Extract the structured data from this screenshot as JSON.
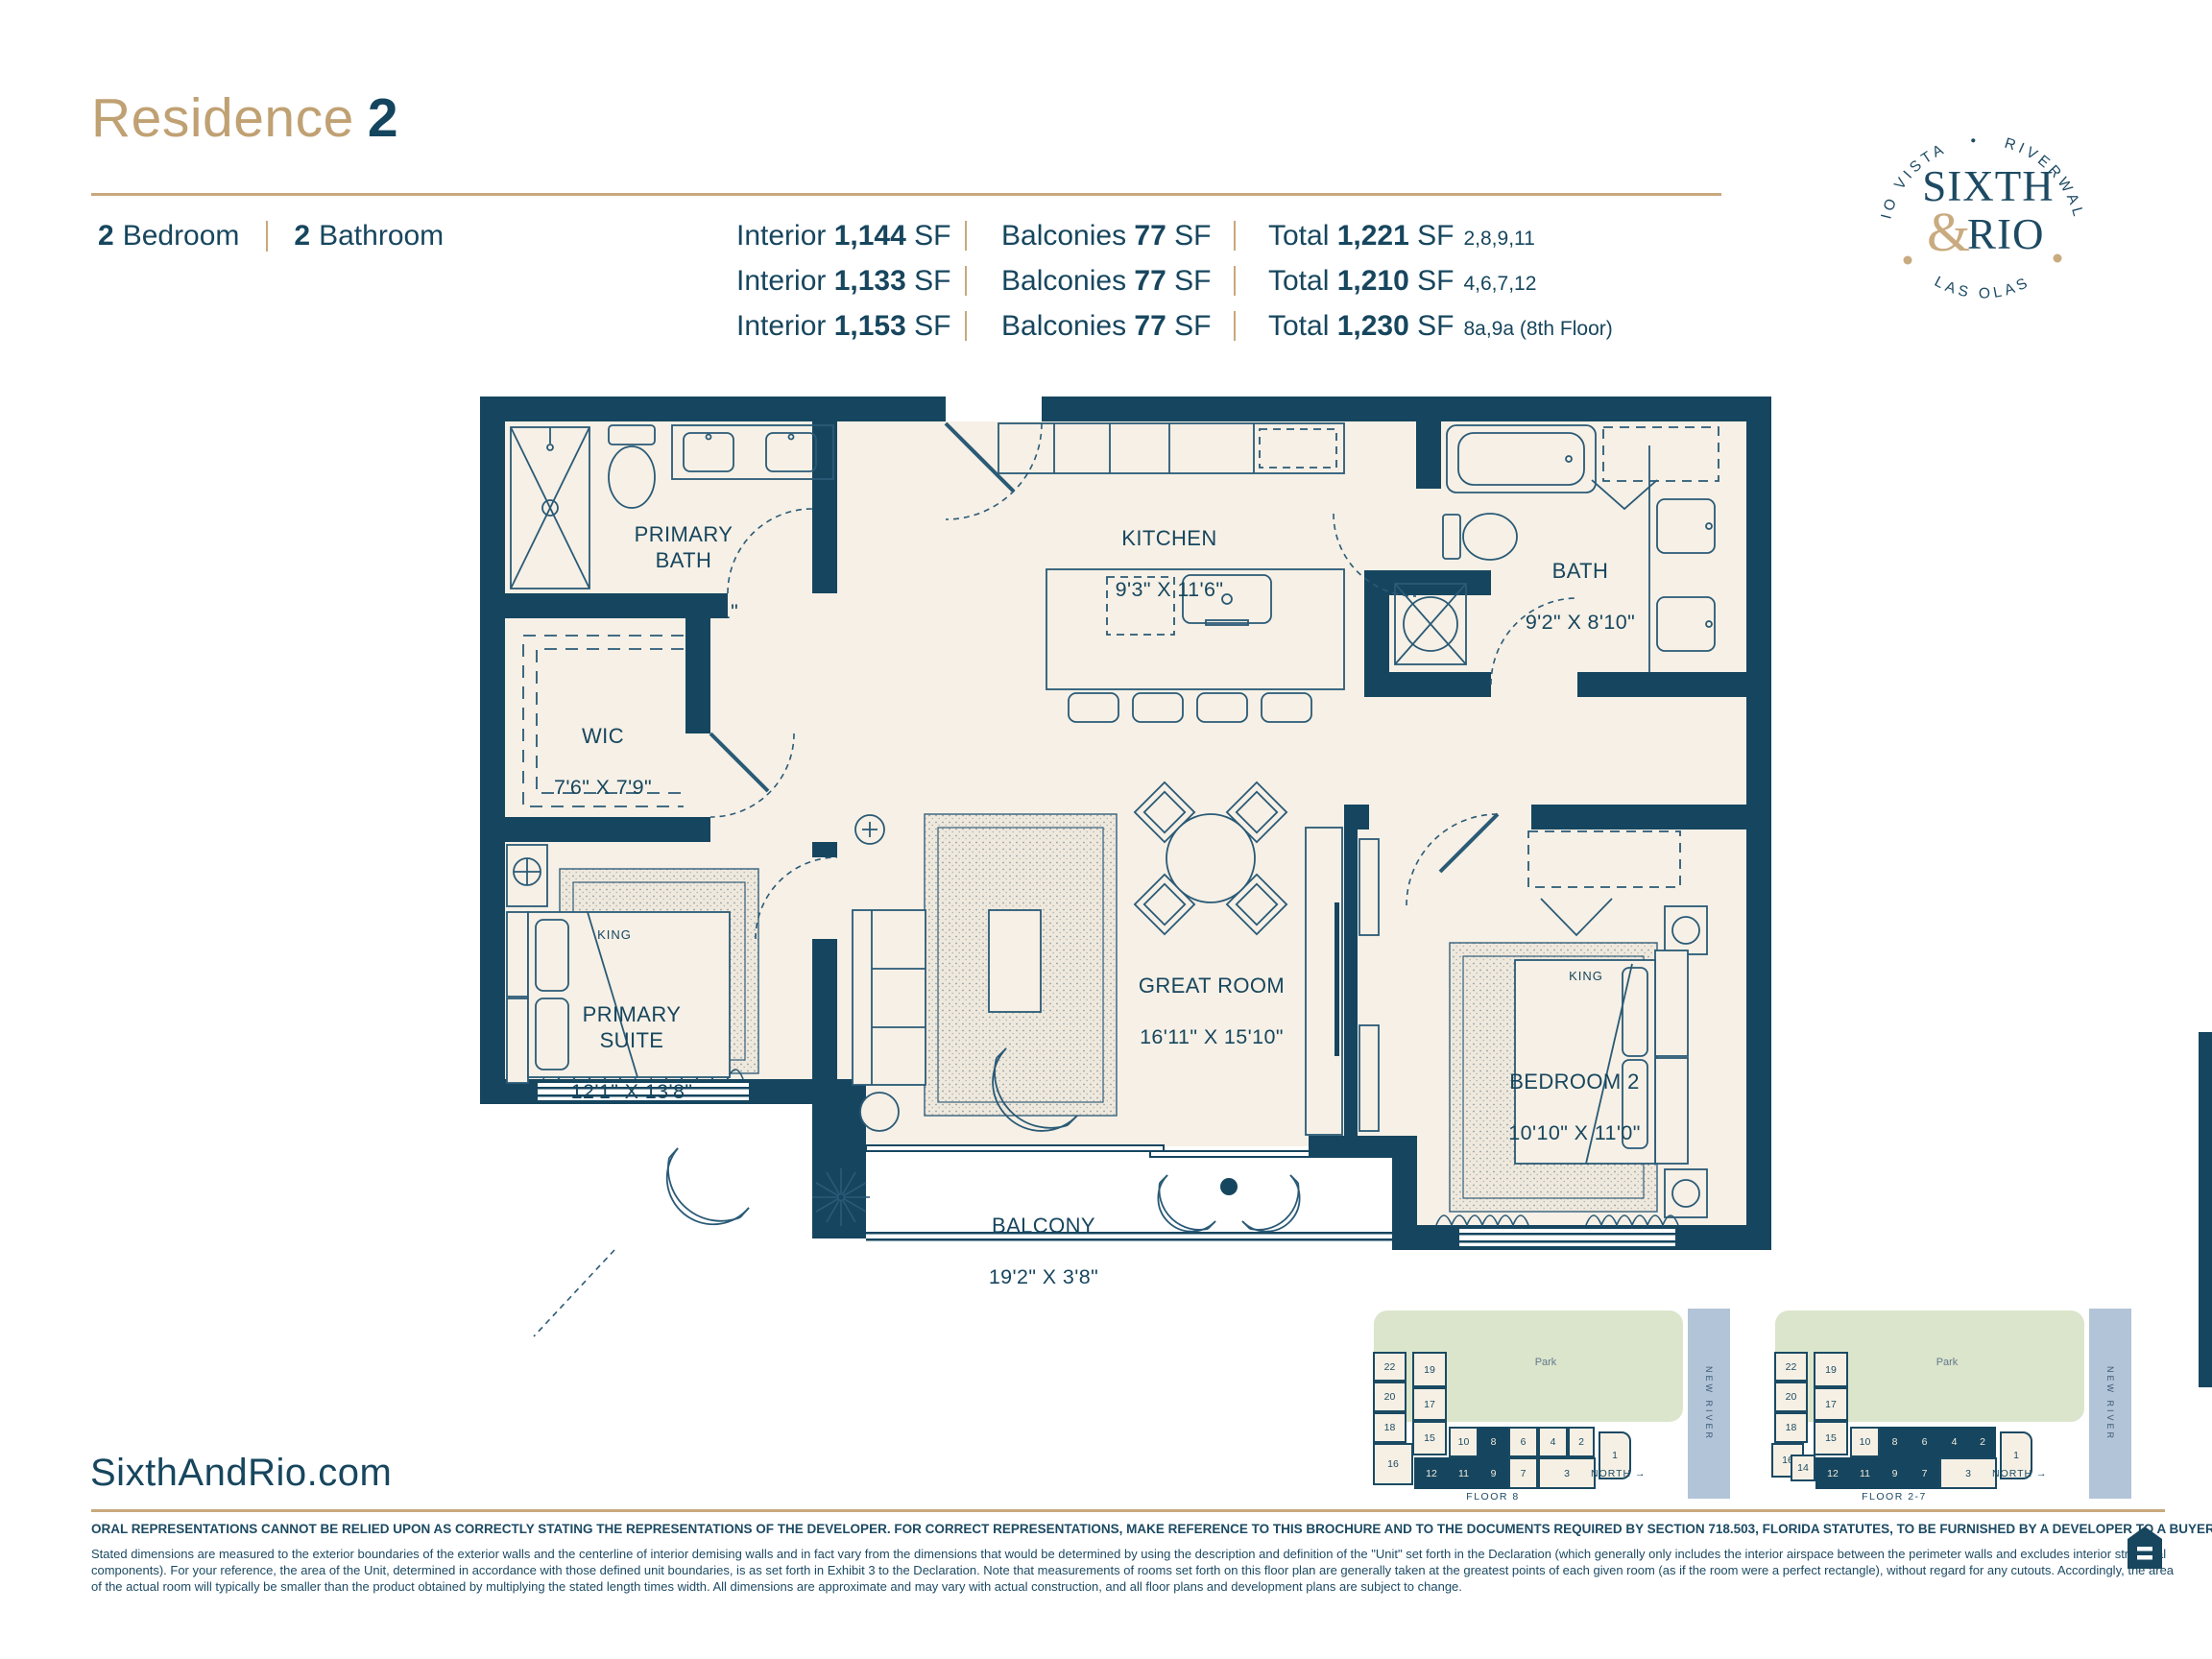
{
  "colors": {
    "navy": "#16465f",
    "tan": "#c8a87c",
    "cream": "#f6f0e6",
    "park_green": "#dbe5cc",
    "river_blue": "#b2c4d8"
  },
  "header": {
    "title_word": "Residence",
    "title_number": "2",
    "bedrooms": "2",
    "bedrooms_label": "Bedroom",
    "bathrooms": "2",
    "bathrooms_label": "Bathroom"
  },
  "area_table": {
    "rows": [
      {
        "interior_label": "Interior",
        "interior_value": "1,144",
        "interior_unit": "SF",
        "balconies_label": "Balconies",
        "balconies_value": "77",
        "balconies_unit": "SF",
        "total_label": "Total",
        "total_value": "1,221",
        "total_unit": "SF",
        "units": "2,8,9,11"
      },
      {
        "interior_label": "Interior",
        "interior_value": "1,133",
        "interior_unit": "SF",
        "balconies_label": "Balconies",
        "balconies_value": "77",
        "balconies_unit": "SF",
        "total_label": "Total",
        "total_value": "1,210",
        "total_unit": "SF",
        "units": "4,6,7,12"
      },
      {
        "interior_label": "Interior",
        "interior_value": "1,153",
        "interior_unit": "SF",
        "balconies_label": "Balconies",
        "balconies_value": "77",
        "balconies_unit": "SF",
        "total_label": "Total",
        "total_value": "1,230",
        "total_unit": "SF",
        "units": "8a,9a (8th Floor)"
      }
    ]
  },
  "logo": {
    "arc_top": "RIO VISTA   •   RIVERWALK",
    "arc_bottom": "LAS OLAS",
    "word1": "SIXTH",
    "amp": "&",
    "word2": "RIO"
  },
  "plan": {
    "king_label": "KING",
    "rooms": [
      {
        "name": "PRIMARY\nBATH",
        "dims": "12'1\" X 6'1\""
      },
      {
        "name": "WIC",
        "dims": "7'6\" X 7'9\""
      },
      {
        "name": "KITCHEN",
        "dims": "9'3\" X 11'6\""
      },
      {
        "name": "BATH",
        "dims": "9'2\" X 8'10\""
      },
      {
        "name": "PRIMARY\nSUITE",
        "dims": "12'1\" X 13'8\""
      },
      {
        "name": "GREAT ROOM",
        "dims": "16'11\" X 15'10\""
      },
      {
        "name": "BEDROOM 2",
        "dims": "10'10\" X 11'0\""
      },
      {
        "name": "BALCONY",
        "dims": "19'2\" X 3'8\""
      }
    ]
  },
  "keyplan": {
    "park_label": "Park",
    "river_label": "NEW RIVER",
    "north_label": "NORTH →",
    "units": {
      "u1": "1",
      "u2": "2",
      "u3": "3",
      "u4": "4",
      "u6": "6",
      "u7": "7",
      "u8": "8",
      "u9": "9",
      "u10": "10",
      "u11": "11",
      "u12": "12",
      "u14": "14",
      "u15": "15",
      "u16": "16",
      "u17": "17",
      "u18": "18",
      "u19": "19",
      "u20": "20",
      "u22": "22"
    },
    "plans": [
      {
        "caption": "FLOOR 8"
      },
      {
        "caption": "FLOOR 2-7"
      }
    ]
  },
  "footer": {
    "website": "SixthAndRio.com",
    "legal_bold": "ORAL REPRESENTATIONS CANNOT BE RELIED UPON AS CORRECTLY STATING THE REPRESENTATIONS OF THE DEVELOPER.  FOR CORRECT REPRESENTATIONS, MAKE REFERENCE TO THIS BROCHURE AND TO THE DOCUMENTS REQUIRED BY SECTION 718.503, FLORIDA STATUTES, TO BE FURNISHED BY A DEVELOPER TO A BUYER OR LESSEE.",
    "legal_lines": [
      "Stated dimensions are measured to the exterior boundaries of the exterior walls and the centerline of interior demising walls and in fact vary from the dimensions that would be determined by using the description and definition of the \"Unit\" set forth in the Declaration (which generally only includes the interior airspace between the perimeter walls and excludes interior structural",
      "components).  For your reference, the area of the Unit, determined in accordance with those defined unit boundaries, is as set forth in Exhibit 3 to the Declaration. Note that measurements of rooms set forth on this floor plan are generally taken at the greatest points of each given room (as if the room were a perfect rectangle), without regard for any cutouts. Accordingly, the area",
      "of the actual room will typically be smaller than the product obtained by multiplying the stated length times width. All dimensions are approximate and may vary with actual construction, and all floor plans and development plans are subject to change."
    ]
  }
}
